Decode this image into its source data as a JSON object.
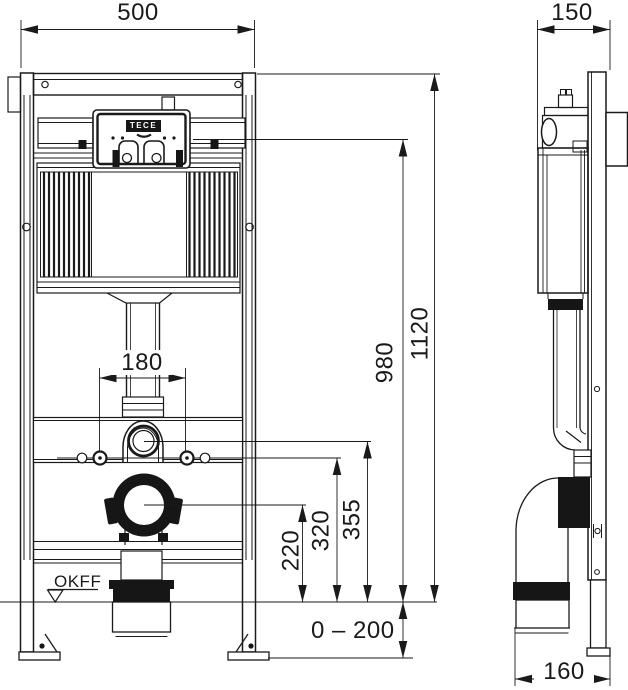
{
  "drawing": {
    "brand_label": "TECE",
    "floor_reference_label": "OKFF",
    "front_view": {
      "width_mm": "500",
      "total_height_mm": "1120",
      "actuator_level_mm": "980",
      "flush_bend_height_mm": "355",
      "fixing_bolt_height_mm": "320",
      "outlet_height_mm": "220",
      "fixing_bolt_spacing_mm": "180",
      "feet_adjustment_range_mm": "0 – 200"
    },
    "side_view": {
      "depth_mm": "150",
      "outlet_offset_mm": "160"
    }
  }
}
